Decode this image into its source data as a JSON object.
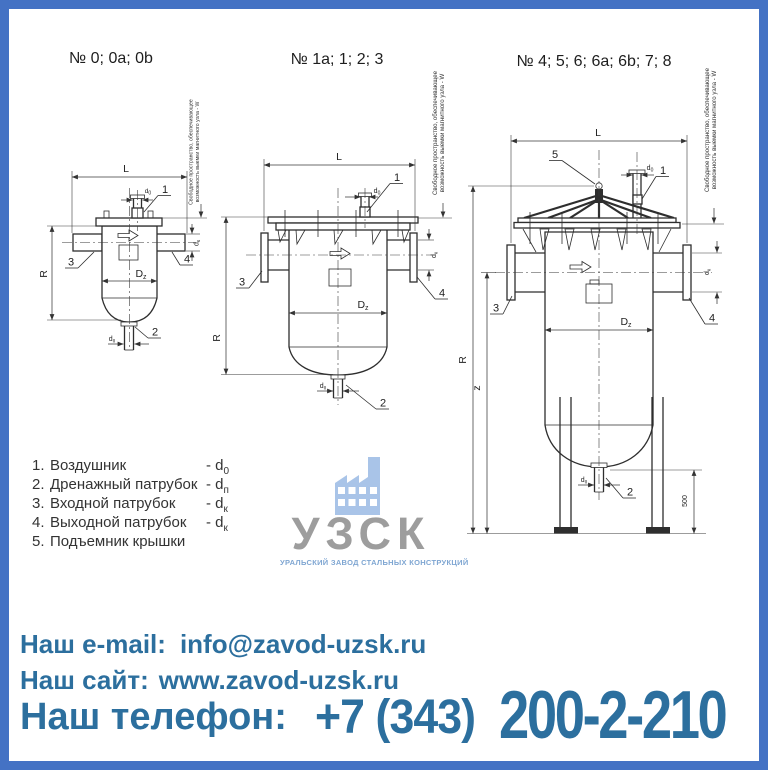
{
  "colors": {
    "border": "#4472c4",
    "contact_text": "#2c6f9e",
    "logo_gray": "#9d9d9d",
    "logo_blue": "#a9c4e8",
    "logo_tagline_blue": "#7fa6d2",
    "line": "#2e2e2e"
  },
  "drawings": [
    {
      "title": "№ 0; 0а; 0b"
    },
    {
      "title": "№ 1а; 1; 2; 3"
    },
    {
      "title": "№ 4; 5; 6; 6а; 6b; 7; 8"
    }
  ],
  "note": {
    "line1": "Свободное пространство, обеспечивающее",
    "line2": "возможность выемки магнитного узла - W"
  },
  "dims": {
    "L": "L",
    "R": "R",
    "z": "z",
    "leg": "500",
    "Dz": {
      "main": "D",
      "sub": "z"
    },
    "d0": {
      "main": "d",
      "sub": "0"
    },
    "dk": {
      "main": "d",
      "sub": "к"
    },
    "dp": {
      "main": "d",
      "sub": "п"
    }
  },
  "callouts": {
    "c1": "1",
    "c2": "2",
    "c3": "3",
    "c4": "4",
    "c5": "5"
  },
  "legend": {
    "items": [
      {
        "num": "1.",
        "label": "Воздушник",
        "dim_prefix": "- d",
        "dim_sub": "0"
      },
      {
        "num": "2.",
        "label": "Дренажный патрубок",
        "dim_prefix": "- d",
        "dim_sub": "п"
      },
      {
        "num": "3.",
        "label": "Входной патрубок",
        "dim_prefix": "- d",
        "dim_sub": "к"
      },
      {
        "num": "4.",
        "label": "Выходной патрубок",
        "dim_prefix": "- d",
        "dim_sub": "к"
      },
      {
        "num": "5.",
        "label": "Подъемник крышки",
        "dim_prefix": "",
        "dim_sub": ""
      }
    ]
  },
  "logo": {
    "name": "УЗСК",
    "tagline": "УРАЛЬСКИЙ ЗАВОД СТАЛЬНЫХ КОНСТРУКЦИЙ"
  },
  "contacts": {
    "email_label": "Наш e-mail:",
    "email": "info@zavod-uzsk.ru",
    "site_label": "Наш сайт:",
    "site": "www.zavod-uzsk.ru",
    "phone_label": "Наш телефон:",
    "phone_prefix": "+7 (343)",
    "phone_number": "200-2-210"
  }
}
